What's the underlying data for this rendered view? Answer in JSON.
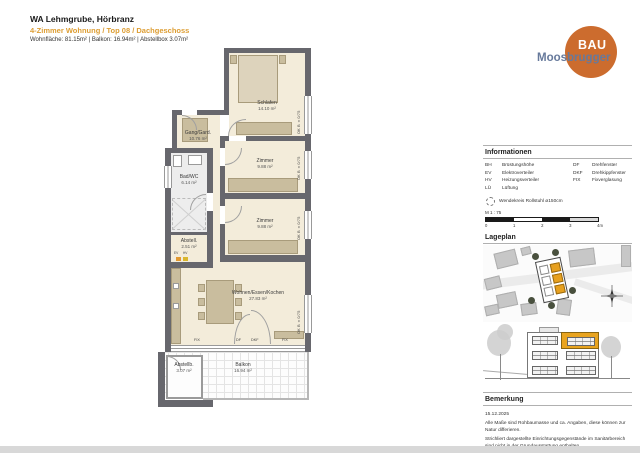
{
  "header": {
    "title": "WA Lehmgrube, Hörbranz",
    "subtitle": "4-Zimmer Wohnung / Top 08 / Dachgeschoss",
    "meta": "Wohnfläche: 81.15m² | Balkon: 16.94m² | Abstellbox 3.07m²"
  },
  "logo": {
    "line1": "BAU",
    "line2": "Moosbrugger"
  },
  "plan": {
    "rooms": {
      "schlafen": {
        "name": "Schlafen",
        "area": "14.10 m²"
      },
      "gang": {
        "name": "Gang/Gard.",
        "area": "10.76 m²"
      },
      "zimmer1": {
        "name": "Zimmer",
        "area": "9.88 m²"
      },
      "zimmer2": {
        "name": "Zimmer",
        "area": "9.88 m²"
      },
      "bad": {
        "name": "Bad/WC",
        "area": "6.14 m²"
      },
      "abstell": {
        "name": "Abstell.",
        "area": "2.51 m²"
      },
      "wohnen": {
        "name": "Wohnen/Essen/Kochen",
        "area": "27.83 m²"
      },
      "abstellbox": {
        "name": "Abstellb.",
        "area": "3.07 m²"
      },
      "balkon": {
        "name": "Balkon",
        "area": "16.94 m²"
      }
    },
    "window_labels": {
      "w1": "FIX",
      "w2": "DF",
      "w3": "DKF",
      "w4": "FIX"
    },
    "side_window_label": "OK B ±0/75",
    "markers": {
      "ev": "EV",
      "hv": "HV"
    }
  },
  "panel": {
    "info": {
      "title": "Informationen",
      "left": [
        {
          "abbr": "BH",
          "label": "Brüstungshöhe"
        },
        {
          "abbr": "EV",
          "label": "Elektroverteiler"
        },
        {
          "abbr": "HV",
          "label": "Heizungsverteiler"
        },
        {
          "abbr": "LÜ",
          "label": "Lüftung"
        }
      ],
      "right": [
        {
          "abbr": "DF",
          "label": "Drehfenster"
        },
        {
          "abbr": "DKF",
          "label": "Drehkippfenster"
        },
        {
          "abbr": "FIX",
          "label": "Fixverglasung"
        }
      ],
      "wheelchair": "Wendekreis Rollstuhl ø150cm",
      "scale_label": "M 1 : 75",
      "ticks": [
        "0",
        "1",
        "2",
        "3",
        "4m"
      ]
    },
    "lageplan_title": "Lageplan",
    "bemerkung": {
      "title": "Bemerkung",
      "date": "15.12.2025",
      "note1": "Alle Maße sind Rohbaumasse und ca. Angaben, diese können zur Natur differieren.",
      "note2": "Strichliert dargestellte Einrichtungsgegenstände im Sanitärbereich sind nicht in der Grundausstattung enthalten."
    }
  },
  "colors": {
    "accent_orange": "#cc6c2e",
    "highlight_orange": "#e7a01e",
    "brand_blue": "#66799b"
  }
}
